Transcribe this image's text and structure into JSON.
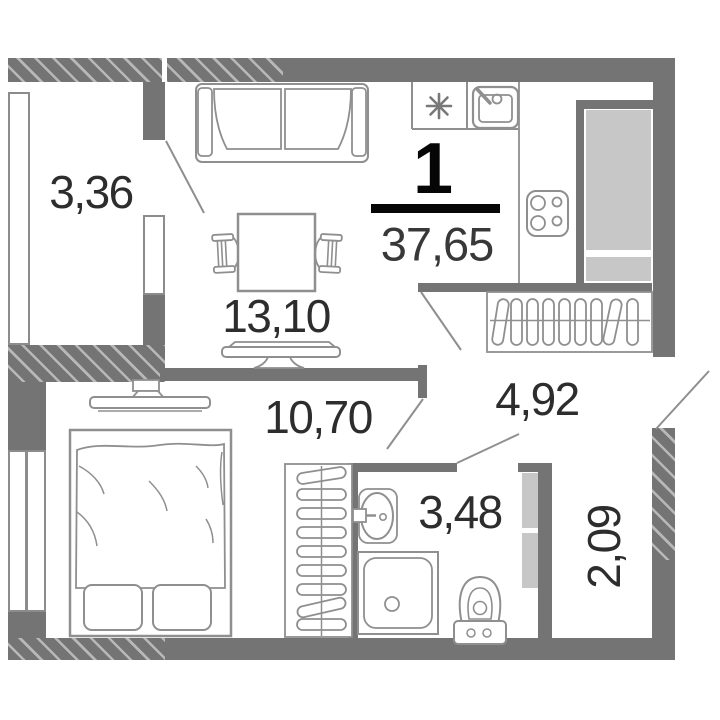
{
  "summary": {
    "rooms_count": "1",
    "total_area": "37,65"
  },
  "areas": {
    "loggia_left": "3,36",
    "living_room": "13,10",
    "bedroom": "10,70",
    "hallway": "4,92",
    "bathroom": "3,48",
    "loggia_right": "2,09"
  },
  "icons": {
    "stove_burner_symbol": "asterisk-8-spoke",
    "appliances": [
      "kitchen-sink-icon",
      "hob-4-burners-icon",
      "fridge-icon",
      "washbasin-icon",
      "shower-tray-icon",
      "toilet-icon"
    ],
    "furniture": [
      "sofa-icon",
      "dining-table-icon",
      "chair-icon",
      "tv-icon",
      "double-bed-icon",
      "wardrobe-hangers-icon",
      "coat-rack-icon"
    ]
  },
  "colors": {
    "wall": "#747474",
    "wall_hatch_line": "#b8b8b8",
    "appliance_fill": "#c7c7c7",
    "furniture_outline": "#8f8f8f",
    "label_text": "#2d2d2d",
    "accent_black": "#060606"
  }
}
